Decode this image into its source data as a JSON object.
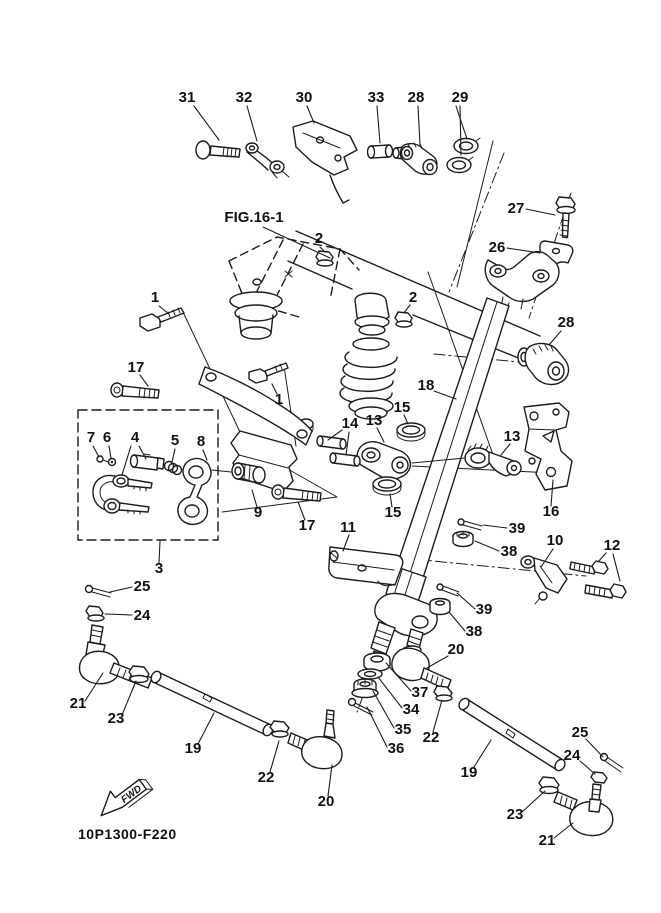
{
  "figure": {
    "drawing_number": "10P1300-F220",
    "fwd_label": "FWD"
  },
  "style": {
    "background": "#ffffff",
    "line_color": "#1c1c1c",
    "label_color": "#111111"
  },
  "diagram": {
    "callouts": [
      {
        "label": "31",
        "x": 187,
        "y": 102,
        "leaders": [
          [
            194,
            106,
            219,
            140
          ]
        ]
      },
      {
        "label": "32",
        "x": 244,
        "y": 102,
        "leaders": [
          [
            247,
            106,
            257,
            141
          ]
        ]
      },
      {
        "label": "30",
        "x": 304,
        "y": 102,
        "leaders": [
          [
            307,
            106,
            314,
            123
          ]
        ]
      },
      {
        "label": "33",
        "x": 376,
        "y": 102,
        "leaders": [
          [
            377,
            106,
            380,
            143
          ]
        ]
      },
      {
        "label": "28",
        "x": 416,
        "y": 102,
        "leaders": [
          [
            418,
            106,
            420,
            145
          ]
        ]
      },
      {
        "label": "29",
        "x": 460,
        "y": 102,
        "leaders": [
          [
            456,
            106,
            467,
            139
          ],
          [
            460,
            106,
            461,
            155
          ]
        ]
      },
      {
        "label": "27",
        "x": 516,
        "y": 213,
        "leaders": [
          [
            526,
            209,
            555,
            215
          ]
        ]
      },
      {
        "label": "26",
        "x": 497,
        "y": 252,
        "leaders": [
          [
            507,
            248,
            540,
            253
          ]
        ]
      },
      {
        "label": "FIG.16-1",
        "x": 254,
        "y": 222,
        "leaders": [
          [
            263,
            227,
            330,
            258
          ]
        ]
      },
      {
        "label": "2",
        "x": 319,
        "y": 243,
        "leaders": [
          [
            320,
            247,
            325,
            252
          ]
        ]
      },
      {
        "label": "2",
        "x": 413,
        "y": 302,
        "leaders": [
          [
            410,
            305,
            404,
            313
          ]
        ]
      },
      {
        "label": "1",
        "x": 155,
        "y": 302,
        "leaders": [
          [
            159,
            306,
            169,
            314
          ]
        ]
      },
      {
        "label": "28",
        "x": 566,
        "y": 327,
        "leaders": [
          [
            561,
            331,
            549,
            345
          ]
        ]
      },
      {
        "label": "17",
        "x": 136,
        "y": 372,
        "leaders": [
          [
            140,
            375,
            148,
            386
          ]
        ]
      },
      {
        "label": "1",
        "x": 279,
        "y": 404,
        "leaders": [
          [
            277,
            394,
            272,
            384
          ]
        ]
      },
      {
        "label": "18",
        "x": 426,
        "y": 390,
        "leaders": [
          [
            434,
            391,
            456,
            399
          ]
        ]
      },
      {
        "label": "15",
        "x": 402,
        "y": 412,
        "leaders": [
          [
            404,
            415,
            408,
            424
          ]
        ]
      },
      {
        "label": "14",
        "x": 350,
        "y": 428,
        "leaders": [
          [
            342,
            430,
            328,
            440
          ],
          [
            349,
            432,
            346,
            455
          ]
        ]
      },
      {
        "label": "13",
        "x": 374,
        "y": 425,
        "leaders": [
          [
            377,
            428,
            384,
            442
          ]
        ]
      },
      {
        "label": "13",
        "x": 512,
        "y": 441,
        "leaders": [
          [
            510,
            444,
            501,
            455
          ]
        ]
      },
      {
        "label": "16",
        "x": 551,
        "y": 516,
        "leaders": [
          [
            551,
            506,
            553,
            480
          ]
        ]
      },
      {
        "label": "7",
        "x": 91,
        "y": 442,
        "leaders": [
          [
            93,
            446,
            99,
            457
          ]
        ]
      },
      {
        "label": "6",
        "x": 107,
        "y": 442,
        "leaders": [
          [
            109,
            446,
            111,
            458
          ]
        ]
      },
      {
        "label": "4",
        "x": 135,
        "y": 442,
        "leaders": [
          [
            131,
            446,
            122,
            475
          ],
          [
            139,
            446,
            146,
            459
          ]
        ]
      },
      {
        "label": "5",
        "x": 175,
        "y": 445,
        "leaders": [
          [
            175,
            449,
            172,
            462
          ]
        ]
      },
      {
        "label": "8",
        "x": 201,
        "y": 446,
        "leaders": [
          [
            203,
            450,
            207,
            460
          ]
        ]
      },
      {
        "label": "9",
        "x": 258,
        "y": 517,
        "leaders": [
          [
            257,
            507,
            252,
            490
          ]
        ]
      },
      {
        "label": "17",
        "x": 307,
        "y": 530,
        "leaders": [
          [
            305,
            520,
            298,
            502
          ]
        ]
      },
      {
        "label": "15",
        "x": 393,
        "y": 517,
        "leaders": [
          [
            392,
            507,
            390,
            494
          ]
        ]
      },
      {
        "label": "11",
        "x": 348,
        "y": 532,
        "leaders": [
          [
            349,
            535,
            343,
            551
          ]
        ]
      },
      {
        "label": "39",
        "x": 517,
        "y": 533,
        "leaders": [
          [
            507,
            528,
            483,
            525
          ]
        ]
      },
      {
        "label": "38",
        "x": 509,
        "y": 556,
        "leaders": [
          [
            499,
            551,
            475,
            541
          ]
        ]
      },
      {
        "label": "10",
        "x": 555,
        "y": 545,
        "leaders": [
          [
            553,
            549,
            541,
            567
          ]
        ]
      },
      {
        "label": "12",
        "x": 612,
        "y": 550,
        "leaders": [
          [
            606,
            553,
            598,
            562
          ],
          [
            613,
            554,
            620,
            581
          ]
        ]
      },
      {
        "label": "3",
        "x": 159,
        "y": 573,
        "leaders": [
          [
            159,
            563,
            160,
            541
          ]
        ]
      },
      {
        "label": "25",
        "x": 142,
        "y": 591,
        "leaders": [
          [
            132,
            587,
            110,
            592
          ]
        ]
      },
      {
        "label": "24",
        "x": 142,
        "y": 620,
        "leaders": [
          [
            132,
            615,
            105,
            614
          ]
        ]
      },
      {
        "label": "39",
        "x": 484,
        "y": 614,
        "leaders": [
          [
            475,
            609,
            457,
            593
          ]
        ]
      },
      {
        "label": "38",
        "x": 474,
        "y": 636,
        "leaders": [
          [
            465,
            631,
            449,
            612
          ]
        ]
      },
      {
        "label": "20",
        "x": 456,
        "y": 654,
        "leaders": [
          [
            448,
            656,
            427,
            668
          ]
        ]
      },
      {
        "label": "37",
        "x": 420,
        "y": 697,
        "leaders": [
          [
            411,
            691,
            386,
            663
          ]
        ]
      },
      {
        "label": "34",
        "x": 411,
        "y": 714,
        "leaders": [
          [
            402,
            708,
            378,
            677
          ]
        ]
      },
      {
        "label": "35",
        "x": 403,
        "y": 734,
        "leaders": [
          [
            394,
            728,
            373,
            691
          ]
        ]
      },
      {
        "label": "36",
        "x": 396,
        "y": 753,
        "leaders": [
          [
            387,
            747,
            367,
            707
          ]
        ]
      },
      {
        "label": "22",
        "x": 431,
        "y": 742,
        "leaders": [
          [
            433,
            732,
            442,
            700
          ]
        ]
      },
      {
        "label": "19",
        "x": 469,
        "y": 777,
        "leaders": [
          [
            474,
            767,
            491,
            740
          ]
        ]
      },
      {
        "label": "25",
        "x": 580,
        "y": 737,
        "leaders": [
          [
            586,
            739,
            603,
            757
          ]
        ]
      },
      {
        "label": "24",
        "x": 572,
        "y": 760,
        "leaders": [
          [
            580,
            761,
            595,
            774
          ]
        ]
      },
      {
        "label": "23",
        "x": 515,
        "y": 819,
        "leaders": [
          [
            522,
            812,
            545,
            791
          ]
        ]
      },
      {
        "label": "21",
        "x": 547,
        "y": 845,
        "leaders": [
          [
            554,
            838,
            573,
            823
          ]
        ]
      },
      {
        "label": "21",
        "x": 78,
        "y": 708,
        "leaders": [
          [
            85,
            701,
            103,
            673
          ]
        ]
      },
      {
        "label": "23",
        "x": 116,
        "y": 723,
        "leaders": [
          [
            122,
            715,
            136,
            681
          ]
        ]
      },
      {
        "label": "19",
        "x": 193,
        "y": 753,
        "leaders": [
          [
            198,
            744,
            214,
            713
          ]
        ]
      },
      {
        "label": "22",
        "x": 266,
        "y": 782,
        "leaders": [
          [
            270,
            772,
            279,
            741
          ]
        ]
      },
      {
        "label": "20",
        "x": 326,
        "y": 806,
        "leaders": [
          [
            328,
            796,
            332,
            765
          ]
        ]
      }
    ]
  }
}
